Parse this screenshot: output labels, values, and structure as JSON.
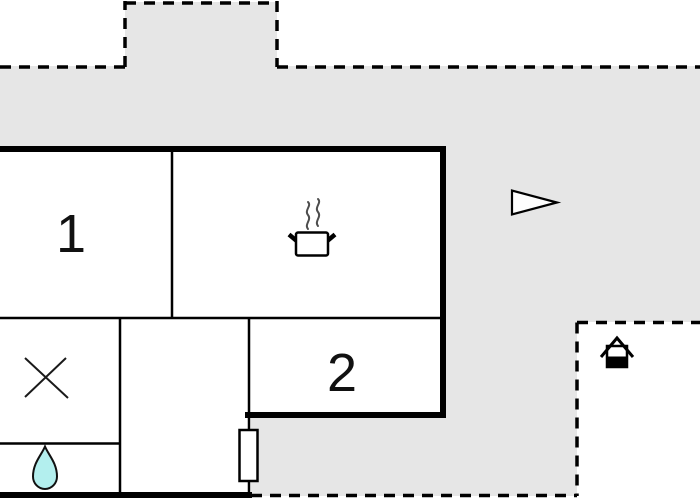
{
  "floor_plan": {
    "rooms": [
      {
        "id": "room-1",
        "label": "1"
      },
      {
        "id": "room-2",
        "label": "2"
      }
    ],
    "symbols": [
      "cooking-pot",
      "x-mark",
      "water-drop",
      "triangle-pennant",
      "grill",
      "door"
    ],
    "colors": {
      "terrace": "#e6e6e6",
      "wall": "#000000",
      "floor": "#ffffff",
      "water_drop_fill": "#b3efee",
      "steam": "#4d4d4d"
    }
  }
}
